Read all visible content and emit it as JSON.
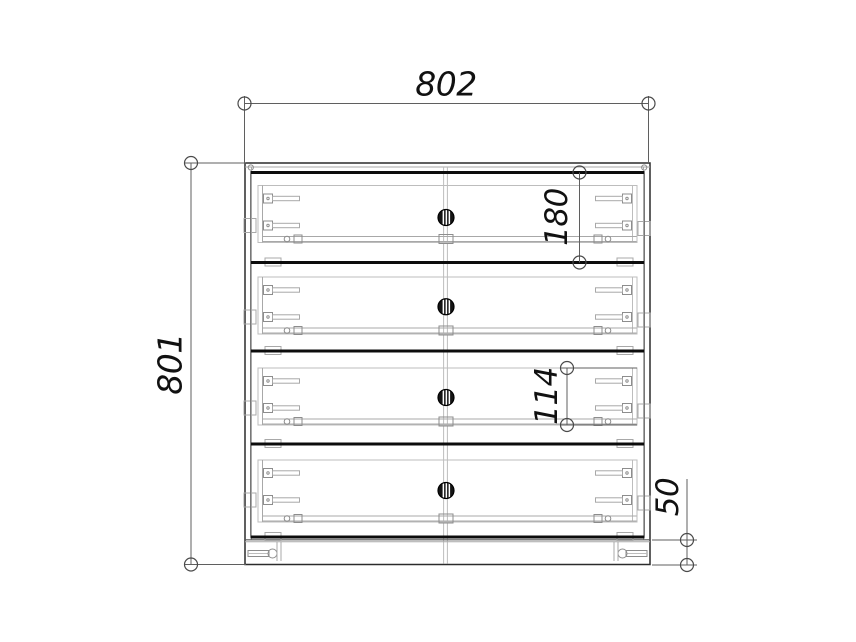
{
  "drawing": {
    "description": "Front elevation of a four-drawer chest with dimensions",
    "dimensions": {
      "overall_width": "802",
      "overall_height": "801",
      "drawer_front_height": "180",
      "drawer_box_height": "114",
      "base_height": "50"
    },
    "cabinet": {
      "drawer_count": 4
    },
    "colors": {
      "background": "#ffffff",
      "outline": "#2b2b2b",
      "drawer_edge": "#0c0c0c",
      "hardware": "#8d8d8d",
      "dimension_line": "#5f5f5f",
      "dimension_text": "#111111"
    }
  }
}
